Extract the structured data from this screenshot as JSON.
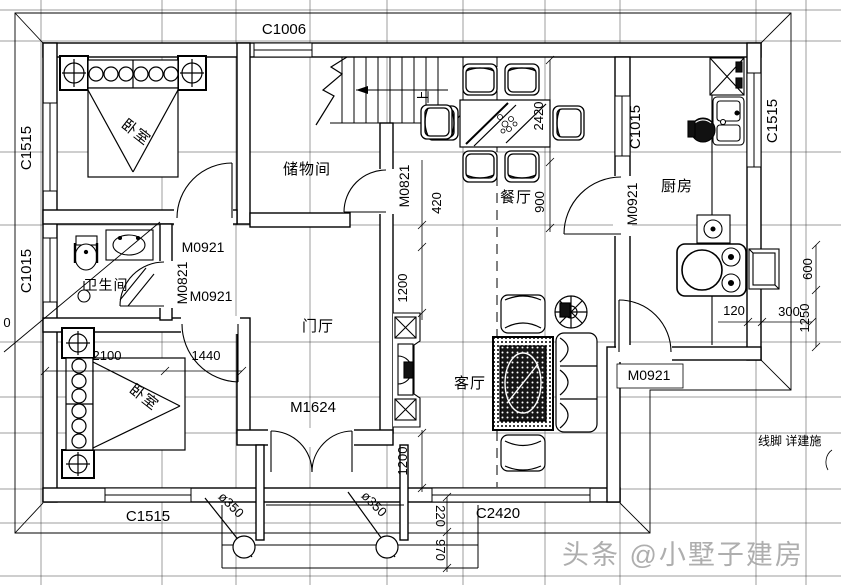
{
  "plan": {
    "rooms": {
      "bedroom1": "卧室",
      "bedroom2": "卧室",
      "storage": "储物间",
      "dining": "餐厅",
      "kitchen": "厨房",
      "bathroom": "卫生间",
      "hall": "门厅",
      "living": "客厅"
    },
    "windows": {
      "top": "C1006",
      "left_bedroom1": "C1515",
      "left_bathroom": "C1015",
      "kitchen_left": "C1015",
      "kitchen_right": "C1515",
      "bedroom2_bottom": "C1515",
      "living_bottom": "C2420"
    },
    "doors": {
      "bedroom1": "M0921",
      "bedroom2": "M0921",
      "bathroom": "M0821",
      "storage_dining": "M0821",
      "kitchen": "M0921",
      "rear": "M0921",
      "entrance": "M1624"
    },
    "dimensions": {
      "d420": "420",
      "d1200_upper": "1200",
      "d1200_lower": "1200",
      "d2420": "2420",
      "d900": "900",
      "d2100": "2100",
      "d1440": "1440",
      "d600": "600",
      "d1250": "1250",
      "d120": "120",
      "d300": "300",
      "d220": "220",
      "d970": "970",
      "partial_zero": "0"
    },
    "columns": {
      "left": "ø350",
      "right": "ø350"
    },
    "notes": {
      "stairs_up": "上",
      "molding": "线脚 详建施"
    },
    "watermark": "头条 @小墅子建房"
  }
}
